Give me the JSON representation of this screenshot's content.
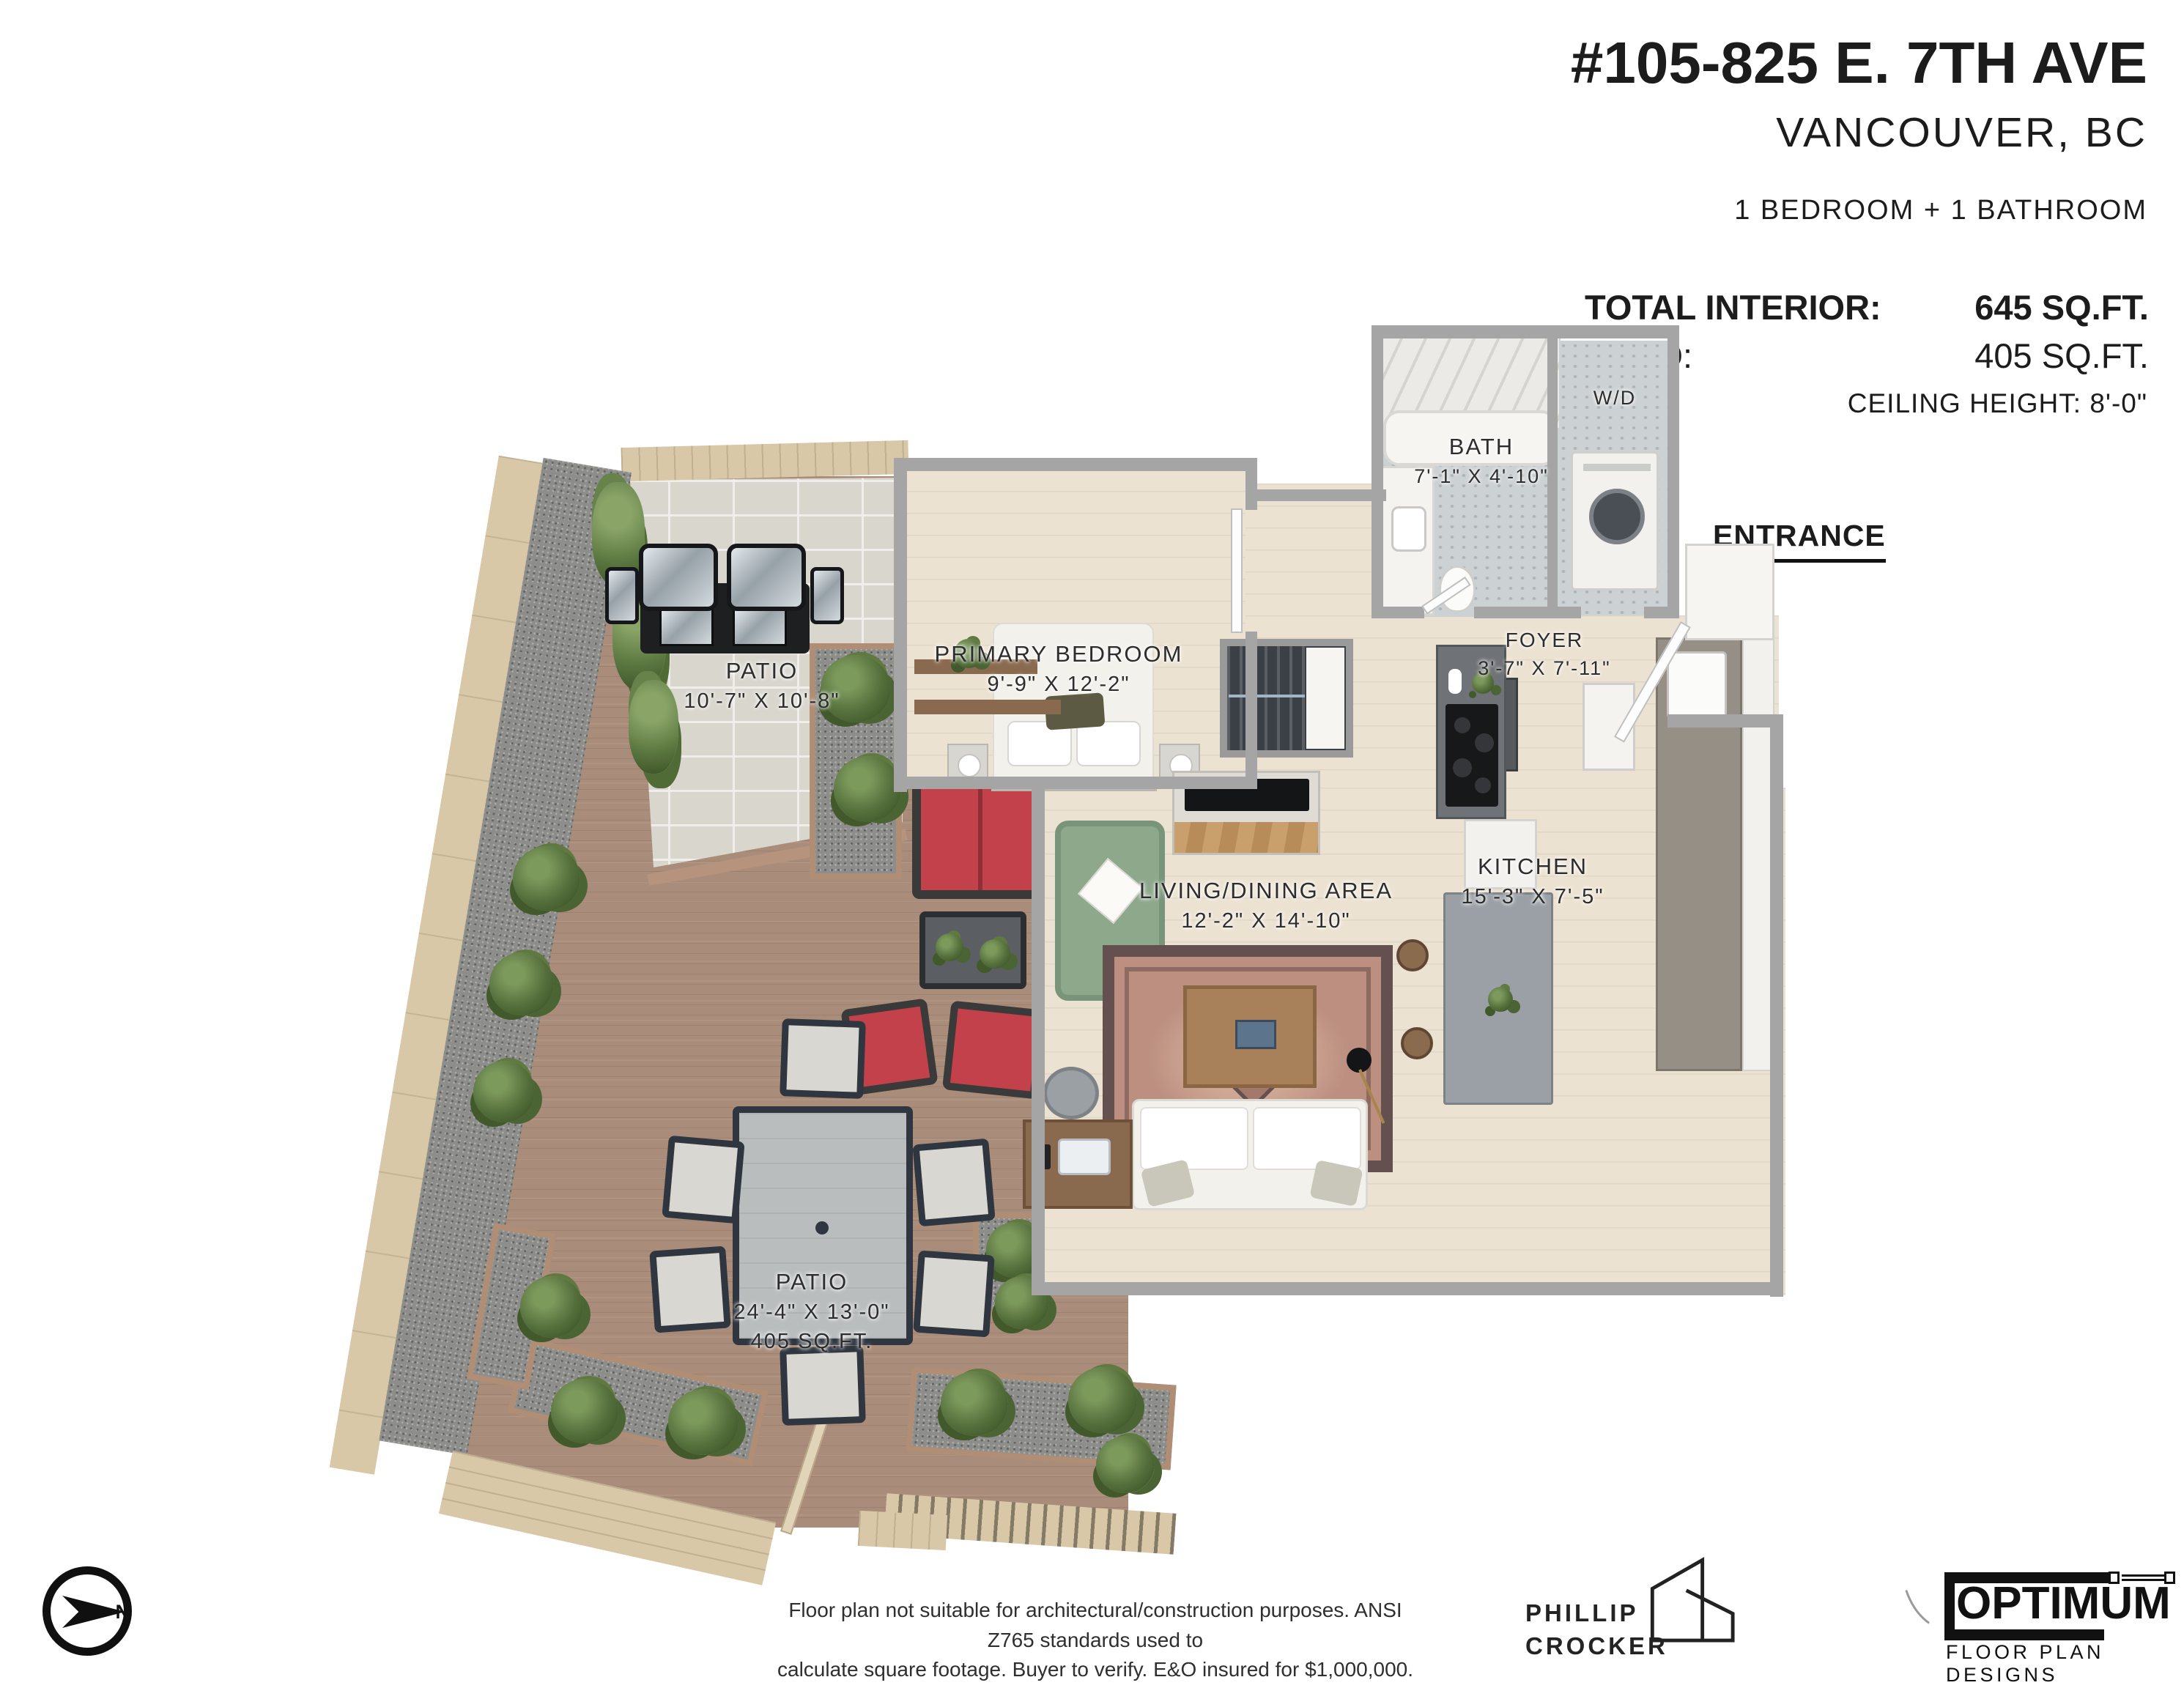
{
  "header": {
    "address": "#105-825 E. 7TH AVE",
    "city": "VANCOUVER, BC",
    "configuration": "1 BEDROOM + 1 BATHROOM",
    "stats": {
      "total_interior_label": "TOTAL INTERIOR:",
      "total_interior_value": "645 SQ.FT.",
      "patio_label": "PATIO:",
      "patio_value": "405 SQ.FT.",
      "ceiling_height": "CEILING HEIGHT: 8'-0\""
    }
  },
  "plan": {
    "entrance_label": "ENTRANCE",
    "rooms": {
      "bath": {
        "name": "BATH",
        "dims": "7'-1\" X 4'-10\""
      },
      "laundry": {
        "name": "W/D"
      },
      "foyer": {
        "name": "FOYER",
        "dims": "3'-7\" X 7'-11\""
      },
      "primary_bedroom": {
        "name": "PRIMARY BEDROOM",
        "dims": "9'-9\" X 12'-2\""
      },
      "living_dining": {
        "name": "LIVING/DINING AREA",
        "dims": "12'-2\" X 14'-10\""
      },
      "kitchen": {
        "name": "KITCHEN",
        "dims": "15'-3\" X 7'-5\""
      },
      "patio_upper": {
        "name": "PATIO",
        "dims": "10'-7\" X 10'-8\""
      },
      "patio_lower": {
        "name": "PATIO",
        "dims": "24'-4\" X 13'-0\"",
        "area": "405 SQ.FT."
      }
    },
    "compass": {
      "north_label": "N"
    }
  },
  "footer": {
    "disclaimer_line1": "Floor plan not suitable for architectural/construction purposes. ANSI Z765 standards used to",
    "disclaimer_line2": "calculate square footage. Buyer to verify.  E&O insured for $1,000,000.",
    "designer_name_line1": "PHILLIP",
    "designer_name_line2": "CROCKER",
    "company_name": "OPTIMUM",
    "company_tagline": "FLOOR PLAN DESIGNS"
  },
  "colors": {
    "text": "#1c1c1c",
    "wall": "#a5a5a5",
    "interior_floor": "#ece2d1",
    "deck_wood": "#a98c79",
    "stone_paver": "#d9d6ce",
    "fence_tan": "#d9c8a8",
    "gravel": "#8d8d8b",
    "bush_green": "#55703c",
    "cushion_red": "#c2414b",
    "armchair_green": "#8ea88c",
    "rug_terracotta": "#bc8f80"
  }
}
